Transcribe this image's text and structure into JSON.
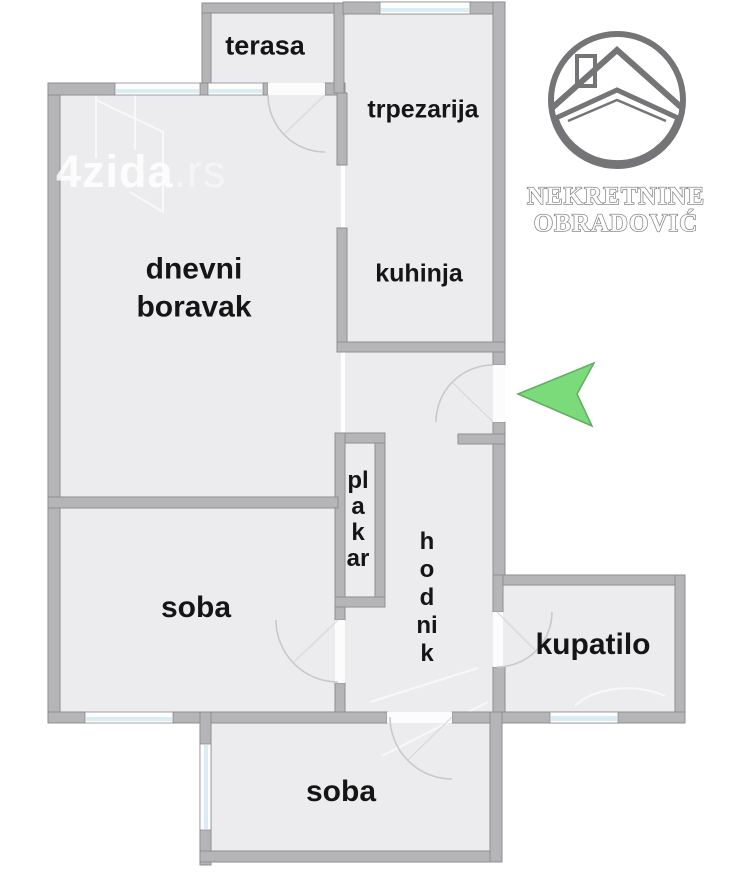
{
  "watermark": {
    "brand": "4zida",
    "domain": ".rs"
  },
  "logo": {
    "name_line1": "NEKRETNINE",
    "name_line2": "OBRADOVIĆ"
  },
  "rooms": {
    "terasa": {
      "label": "terasa"
    },
    "trpezarija": {
      "label": "trpezarija"
    },
    "kuhinja": {
      "label": "kuhinja"
    },
    "dnevni_boravak": {
      "label": "dnevni boravak"
    },
    "plakar": {
      "label": "plakar"
    },
    "hodnik": {
      "label": "hodnik"
    },
    "soba_left": {
      "label": "soba"
    },
    "kupatilo": {
      "label": "kupatilo"
    },
    "soba_bottom": {
      "label": "soba"
    }
  },
  "icons": {
    "entrance_arrow": "left-arrow"
  },
  "colors": {
    "wall": "#b5b5b7",
    "wall_border": "#8e8e90",
    "floor": "#ececee",
    "window_glass": "#d9edf2",
    "arrow": "#7bdb7b",
    "arrow_border": "#5fae60",
    "label_text": "#151515",
    "logo_outline": "#757578"
  }
}
